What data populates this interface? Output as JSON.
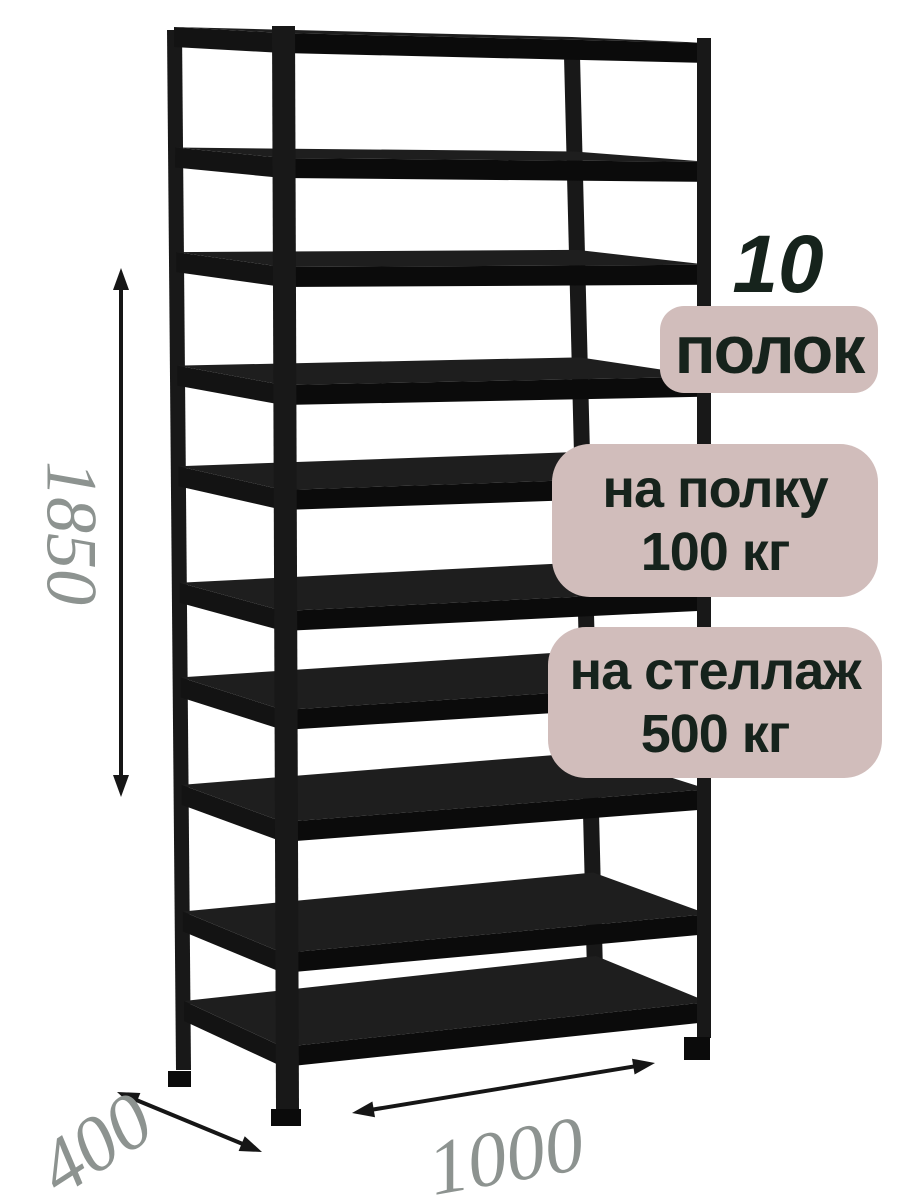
{
  "annotations": {
    "shelf_count_number": "10",
    "shelf_count_label": "полок",
    "shelf_load_line1": "на полку",
    "shelf_load_line2": "100 кг",
    "rack_load_line1": "на стеллаж",
    "rack_load_line2": "500 кг"
  },
  "dimensions": {
    "height": "1850",
    "depth": "400",
    "width": "1000"
  },
  "rack": {
    "shelf_count": 10
  },
  "colors": {
    "background": "#ffffff",
    "badge_bg": "#d1bdbb",
    "badge_text": "#16231c",
    "dimension_text": "#8d9390",
    "rack_black": "#181818",
    "shelf_top": "#1e1e1e",
    "shelf_front": "#0b0b0b",
    "shelf_side": "#131313",
    "arrow": "#161616"
  }
}
